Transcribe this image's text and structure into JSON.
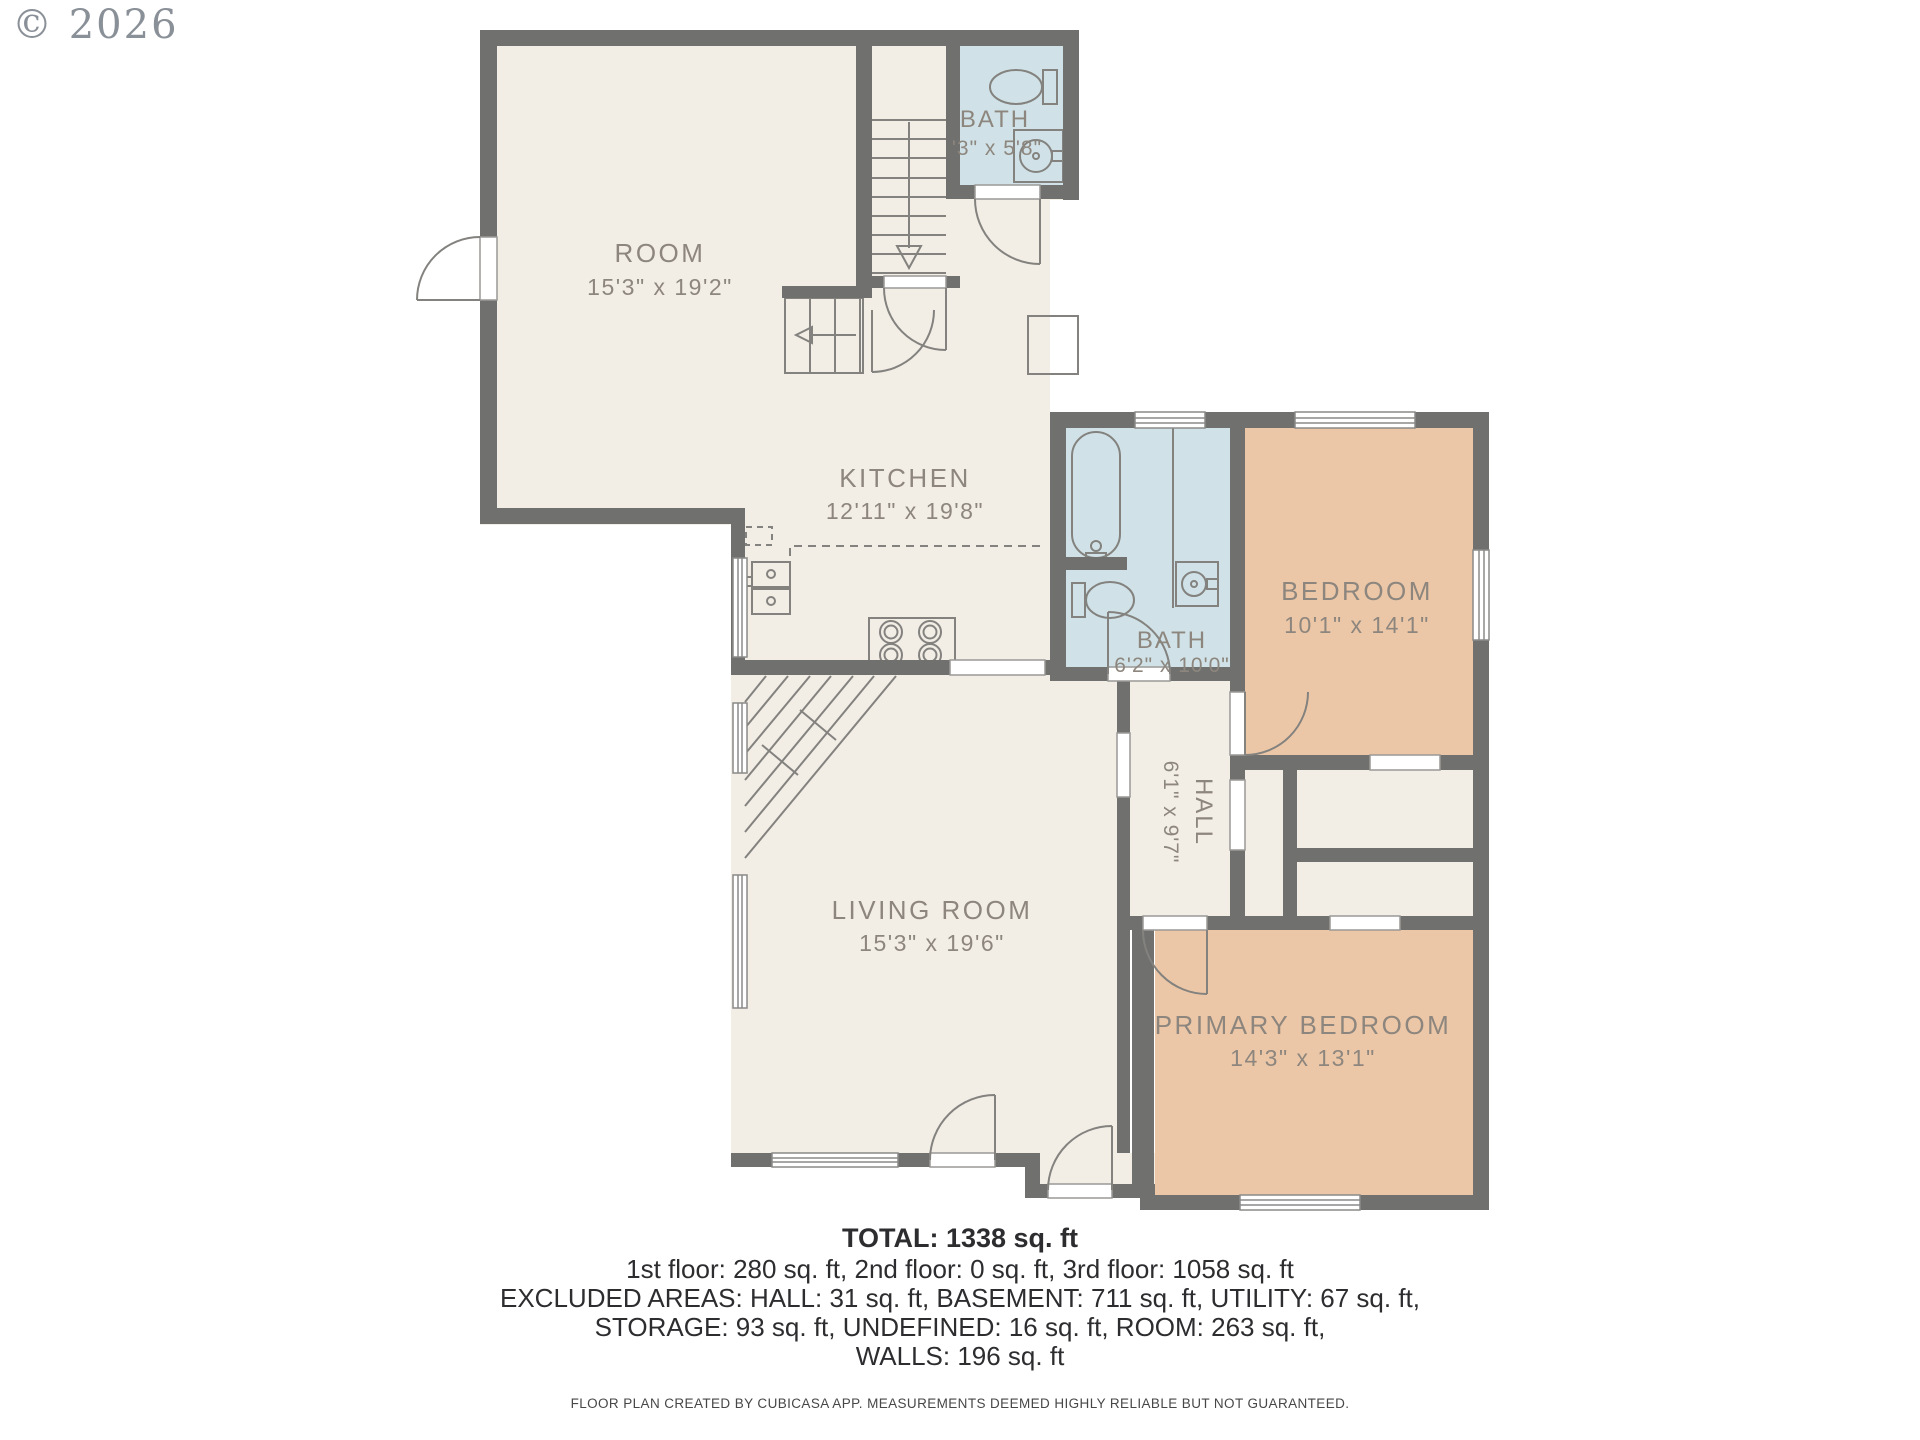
{
  "watermark": "© 2026",
  "rooms": {
    "room": {
      "name": "ROOM",
      "dims": "15'3\" x 19'2\""
    },
    "bath_upper": {
      "name": "BATH",
      "dims": "'3\" x 5'8\""
    },
    "kitchen": {
      "name": "KITCHEN",
      "dims": "12'11\" x 19'8\""
    },
    "bath_main": {
      "name": "BATH",
      "dims": "6'2\" x 10'0\""
    },
    "bedroom": {
      "name": "BEDROOM",
      "dims": "10'1\" x 14'1\""
    },
    "hall": {
      "name": "HALL",
      "dims": "6'1\" x 9'7\""
    },
    "living_room": {
      "name": "LIVING ROOM",
      "dims": "15'3\" x 19'6\""
    },
    "primary_bedroom": {
      "name": "PRIMARY BEDROOM",
      "dims": "14'3\" x 13'1\""
    }
  },
  "summary": {
    "total": "TOTAL: 1338 sq. ft",
    "line1": "1st floor: 280 sq. ft, 2nd floor: 0 sq. ft, 3rd floor: 1058 sq. ft",
    "line2": "EXCLUDED AREAS: HALL: 31 sq. ft, BASEMENT: 711 sq. ft, UTILITY: 67 sq. ft,",
    "line3": "STORAGE: 93 sq. ft, UNDEFINED: 16 sq. ft, ROOM: 263 sq. ft,",
    "line4": "WALLS: 196 sq. ft"
  },
  "footer": "FLOOR PLAN CREATED BY CUBICASA APP. MEASUREMENTS DEEMED HIGHLY RELIABLE BUT NOT GUARANTEED.",
  "colors": {
    "wall": "#70706e",
    "floor": "#f2ede5",
    "bath": "#d0e2e7",
    "bedroom": "#ecc7a7",
    "label": "#8d867e"
  }
}
